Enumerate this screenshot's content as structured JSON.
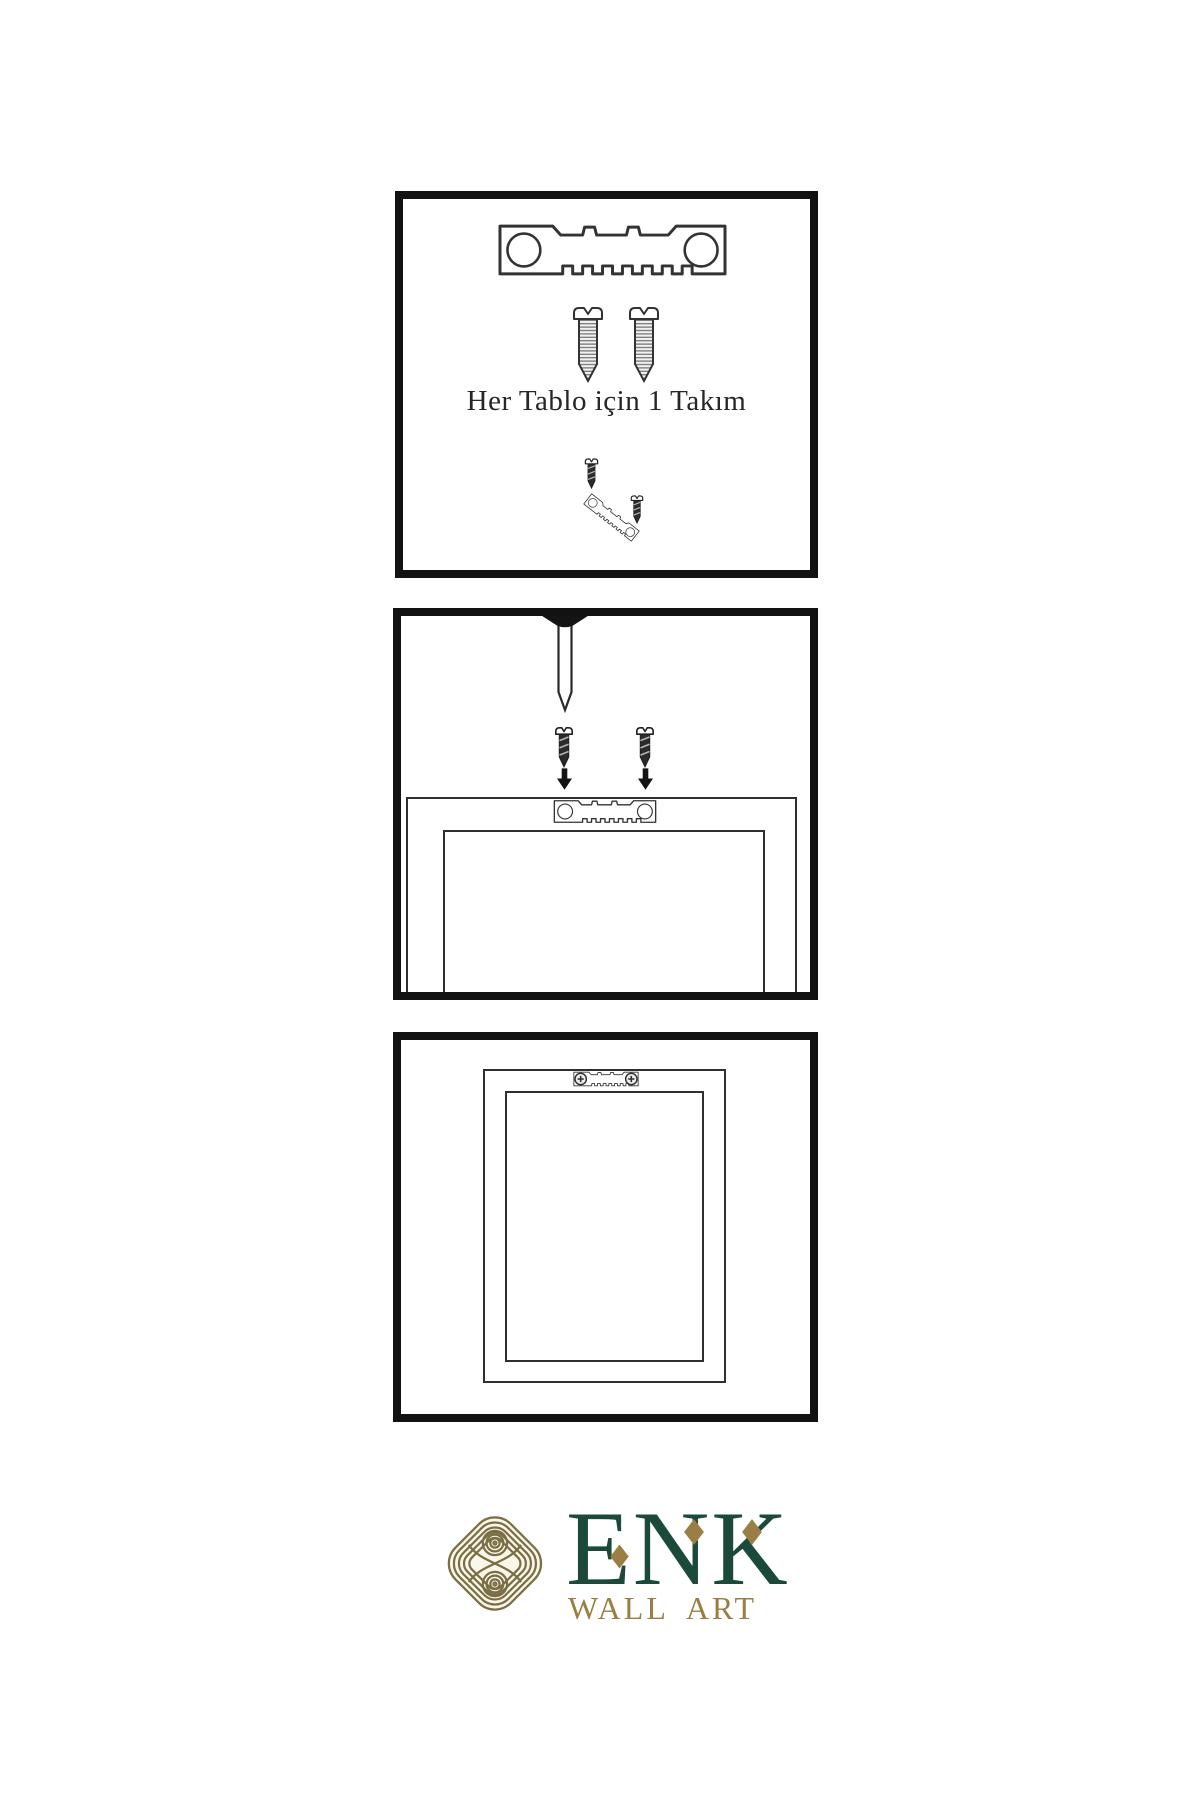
{
  "colors": {
    "ink": "#2f2f2f",
    "panel_border": "#121212",
    "brand_green": "#1b4a3a",
    "brand_gold": "#9a7e44",
    "knot_gold": "#7a6f44"
  },
  "panels": {
    "kit": {
      "caption": "Her Tablo için 1 Takım",
      "icons": [
        "sawtooth-hanger-icon",
        "screw-icon",
        "screw-icon",
        "hanging-kit-icon"
      ]
    },
    "install": {
      "icons": [
        "nail-icon",
        "screw-icon",
        "screw-icon",
        "arrow-down-icon",
        "arrow-down-icon",
        "sawtooth-hanger-icon",
        "frame-back-icon"
      ]
    },
    "result": {
      "icons": [
        "frame-back-icon",
        "mounted-sawtooth-hanger-icon"
      ]
    }
  },
  "logo": {
    "brand": "ENK",
    "subtitle": "WALL ART"
  }
}
